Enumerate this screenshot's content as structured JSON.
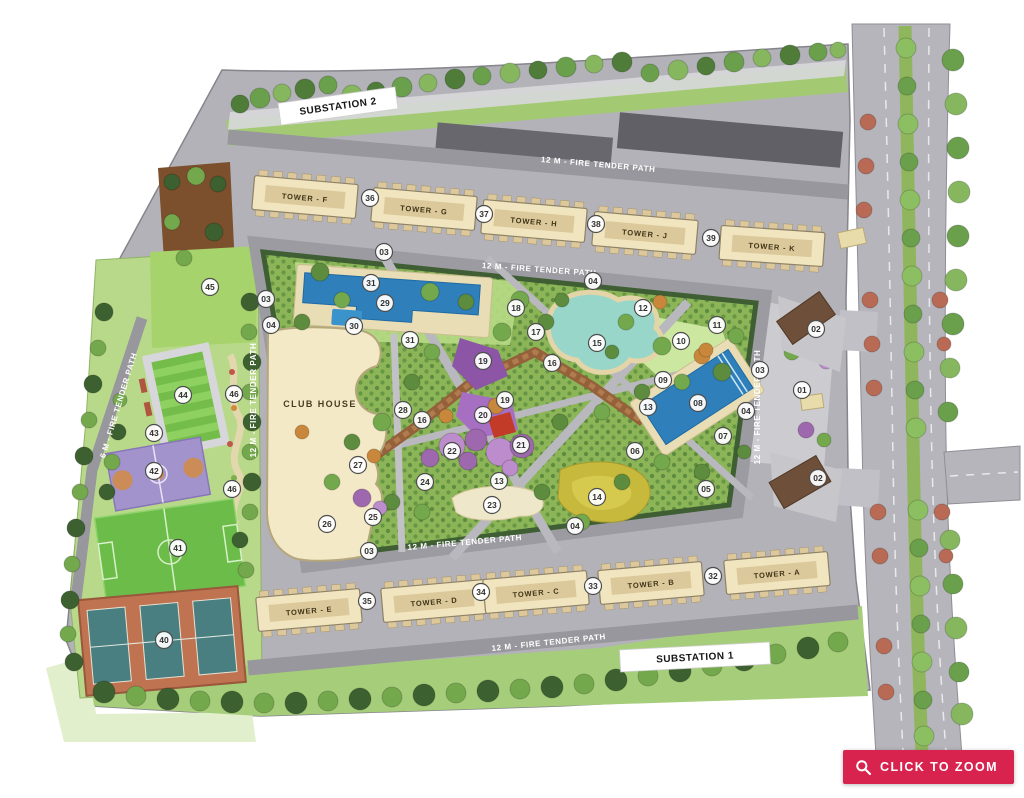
{
  "colors": {
    "accent": "#d7234e",
    "road_gray": "#b2b2b8",
    "tower_cream": "#f1e5bf",
    "pool_blue": "#2e7fba",
    "lawn_green": "#a6d36b",
    "hedge_green": "#3c5a31"
  },
  "zoom_button": {
    "label": "CLICK TO ZOOM"
  },
  "map": {
    "club_house": {
      "label": "CLUB HOUSE",
      "x": 320,
      "y": 407
    },
    "substations": [
      {
        "label": "SUBSTATION 2",
        "x": 338,
        "y": 106,
        "rot": -8,
        "w": 118
      },
      {
        "label": "SUBSTATION 1",
        "x": 695,
        "y": 657,
        "rot": -3,
        "w": 150
      }
    ],
    "path_labels": [
      {
        "text": "12 M - FIRE TENDER PATH",
        "x": 598,
        "y": 167,
        "rot": 5
      },
      {
        "text": "12 M - FIRE TENDER PATH",
        "x": 539,
        "y": 272,
        "rot": 4
      },
      {
        "text": "12 M - FIRE TENDER PATH",
        "x": 465,
        "y": 545,
        "rot": -5
      },
      {
        "text": "12 M - FIRE TENDER PATH",
        "x": 549,
        "y": 645,
        "rot": -6
      },
      {
        "text": "12 M - FIRE TENDER PATH",
        "x": 256,
        "y": 400,
        "rot": -90
      },
      {
        "text": "12 M - FIRE TENDER PATH",
        "x": 760,
        "y": 407,
        "rot": -90
      },
      {
        "text": "6 M - FIRE TENDER PATH",
        "x": 121,
        "y": 406,
        "rot": -73
      }
    ],
    "towers": [
      {
        "label": "TOWER - F",
        "x": 305,
        "y": 197,
        "rot": 5
      },
      {
        "label": "TOWER - G",
        "x": 424,
        "y": 209,
        "rot": 5
      },
      {
        "label": "TOWER - H",
        "x": 534,
        "y": 221,
        "rot": 5
      },
      {
        "label": "TOWER - J",
        "x": 645,
        "y": 233,
        "rot": 5
      },
      {
        "label": "TOWER - K",
        "x": 772,
        "y": 246,
        "rot": 4
      },
      {
        "label": "TOWER - E",
        "x": 309,
        "y": 610,
        "rot": -5
      },
      {
        "label": "TOWER - D",
        "x": 434,
        "y": 601,
        "rot": -5
      },
      {
        "label": "TOWER - C",
        "x": 536,
        "y": 592,
        "rot": -5
      },
      {
        "label": "TOWER - B",
        "x": 651,
        "y": 583,
        "rot": -5
      },
      {
        "label": "TOWER - A",
        "x": 777,
        "y": 573,
        "rot": -5
      }
    ],
    "markers": [
      {
        "n": "36",
        "x": 370,
        "y": 198
      },
      {
        "n": "37",
        "x": 484,
        "y": 214
      },
      {
        "n": "38",
        "x": 596,
        "y": 224
      },
      {
        "n": "39",
        "x": 711,
        "y": 238
      },
      {
        "n": "03",
        "x": 384,
        "y": 252
      },
      {
        "n": "04",
        "x": 593,
        "y": 281
      },
      {
        "n": "03",
        "x": 266,
        "y": 299
      },
      {
        "n": "04",
        "x": 271,
        "y": 325
      },
      {
        "n": "31",
        "x": 371,
        "y": 283
      },
      {
        "n": "29",
        "x": 385,
        "y": 303
      },
      {
        "n": "30",
        "x": 354,
        "y": 326
      },
      {
        "n": "31",
        "x": 410,
        "y": 340
      },
      {
        "n": "18",
        "x": 516,
        "y": 308
      },
      {
        "n": "17",
        "x": 536,
        "y": 332
      },
      {
        "n": "15",
        "x": 597,
        "y": 343
      },
      {
        "n": "16",
        "x": 552,
        "y": 363
      },
      {
        "n": "16",
        "x": 422,
        "y": 420
      },
      {
        "n": "12",
        "x": 643,
        "y": 308
      },
      {
        "n": "11",
        "x": 717,
        "y": 325
      },
      {
        "n": "10",
        "x": 681,
        "y": 341
      },
      {
        "n": "09",
        "x": 663,
        "y": 380
      },
      {
        "n": "08",
        "x": 698,
        "y": 403
      },
      {
        "n": "13",
        "x": 648,
        "y": 407
      },
      {
        "n": "07",
        "x": 723,
        "y": 436
      },
      {
        "n": "06",
        "x": 635,
        "y": 451
      },
      {
        "n": "05",
        "x": 706,
        "y": 489
      },
      {
        "n": "14",
        "x": 597,
        "y": 497
      },
      {
        "n": "03",
        "x": 760,
        "y": 370
      },
      {
        "n": "04",
        "x": 746,
        "y": 411
      },
      {
        "n": "02",
        "x": 816,
        "y": 329
      },
      {
        "n": "01",
        "x": 802,
        "y": 390
      },
      {
        "n": "02",
        "x": 818,
        "y": 478
      },
      {
        "n": "19",
        "x": 483,
        "y": 361
      },
      {
        "n": "19",
        "x": 505,
        "y": 400
      },
      {
        "n": "20",
        "x": 483,
        "y": 415
      },
      {
        "n": "21",
        "x": 521,
        "y": 445
      },
      {
        "n": "22",
        "x": 452,
        "y": 451
      },
      {
        "n": "28",
        "x": 403,
        "y": 410
      },
      {
        "n": "27",
        "x": 358,
        "y": 465
      },
      {
        "n": "26",
        "x": 327,
        "y": 524
      },
      {
        "n": "25",
        "x": 373,
        "y": 517
      },
      {
        "n": "24",
        "x": 425,
        "y": 482
      },
      {
        "n": "13",
        "x": 499,
        "y": 481
      },
      {
        "n": "23",
        "x": 492,
        "y": 505
      },
      {
        "n": "45",
        "x": 210,
        "y": 287
      },
      {
        "n": "44",
        "x": 183,
        "y": 395
      },
      {
        "n": "46",
        "x": 234,
        "y": 394
      },
      {
        "n": "43",
        "x": 154,
        "y": 433
      },
      {
        "n": "42",
        "x": 154,
        "y": 471
      },
      {
        "n": "46",
        "x": 232,
        "y": 489
      },
      {
        "n": "41",
        "x": 178,
        "y": 548
      },
      {
        "n": "40",
        "x": 164,
        "y": 640
      },
      {
        "n": "03",
        "x": 369,
        "y": 551
      },
      {
        "n": "04",
        "x": 575,
        "y": 526
      },
      {
        "n": "35",
        "x": 367,
        "y": 601
      },
      {
        "n": "34",
        "x": 481,
        "y": 592
      },
      {
        "n": "33",
        "x": 593,
        "y": 586
      },
      {
        "n": "32",
        "x": 713,
        "y": 576
      }
    ]
  }
}
